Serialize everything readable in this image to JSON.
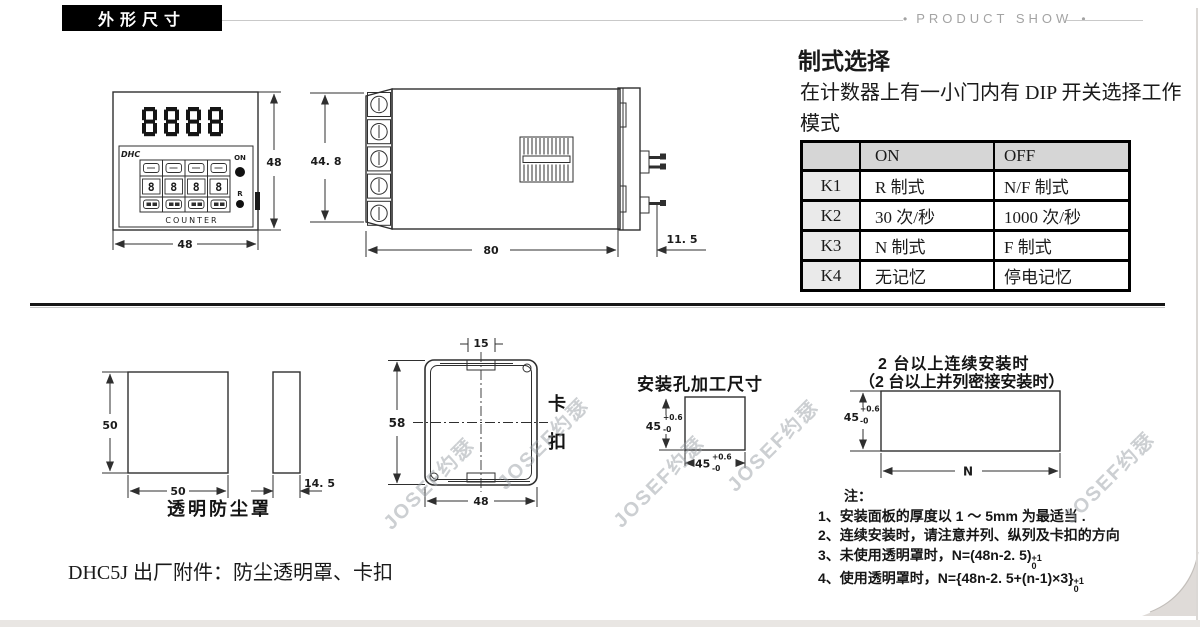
{
  "header": {
    "section_label": "外形尺寸",
    "product_show_label": "PRODUCT SHOW",
    "dot": "•"
  },
  "mode_select": {
    "title": "制式选择",
    "description": "在计数器上有一小门内有 DIP 开关选择工作模式",
    "table": {
      "col_on": "ON",
      "col_off": "OFF",
      "rows": [
        {
          "key": "K1",
          "on": "R 制式",
          "off": "N/F 制式"
        },
        {
          "key": "K2",
          "on": "30 次/秒",
          "off": "1000 次/秒"
        },
        {
          "key": "K3",
          "on": "N 制式",
          "off": "F 制式"
        },
        {
          "key": "K4",
          "on": "无记忆",
          "off": "停电记忆"
        }
      ]
    }
  },
  "front_view": {
    "brand": "DHC",
    "display_digits": "8888",
    "wheel_digit": "8",
    "on_label": "ON",
    "reset_label": "R",
    "counter_label": "COUNTER",
    "width_dim": "48",
    "height_dim": "48"
  },
  "side_view": {
    "height_dim": "44. 8",
    "length_dim": "80",
    "bezel_dim": "11. 5"
  },
  "dust_cover": {
    "height_dim": "50",
    "width_dim": "50",
    "depth_dim": "14. 5",
    "caption": "透明防尘罩"
  },
  "clip": {
    "notch_dim": "15",
    "height_dim": "58",
    "width_dim": "48",
    "caption": "卡扣"
  },
  "mount_hole": {
    "title": "安装孔加工尺寸",
    "v_dim": "45",
    "v_tol_top": "+0.6",
    "v_tol_bottom": "-0",
    "h_dim": "45",
    "h_tol_top": "+0.6",
    "h_tol_bottom": "-0"
  },
  "multi_mount": {
    "title_line1": "2 台以上连续安装时",
    "title_line2": "（2 台以上并列密接安装时）",
    "v_dim": "45",
    "v_tol_top": "+0.6",
    "v_tol_bottom": "-0",
    "n_dim": "N"
  },
  "notes": {
    "label": "注：",
    "item1": "1、安装面板的厚度以 1 ～ 5mm 为最适当 .",
    "item2": "2、连续安装时，请注意并列、纵列及卡扣的方向",
    "item3_text": "3、未使用透明罩时，N=(48n-2. 5)",
    "item3_tol_top": "+1",
    "item3_tol_bottom": "0",
    "item4_text": "4、使用透明罩时，N={48n-2. 5+(n-1)×3}",
    "item4_tol_top": "+1",
    "item4_tol_bottom": "0"
  },
  "footer": {
    "accessories_text": "DHC5J 出厂附件：防尘透明罩、卡扣"
  },
  "watermark": {
    "text": "JOSEF约瑟"
  }
}
